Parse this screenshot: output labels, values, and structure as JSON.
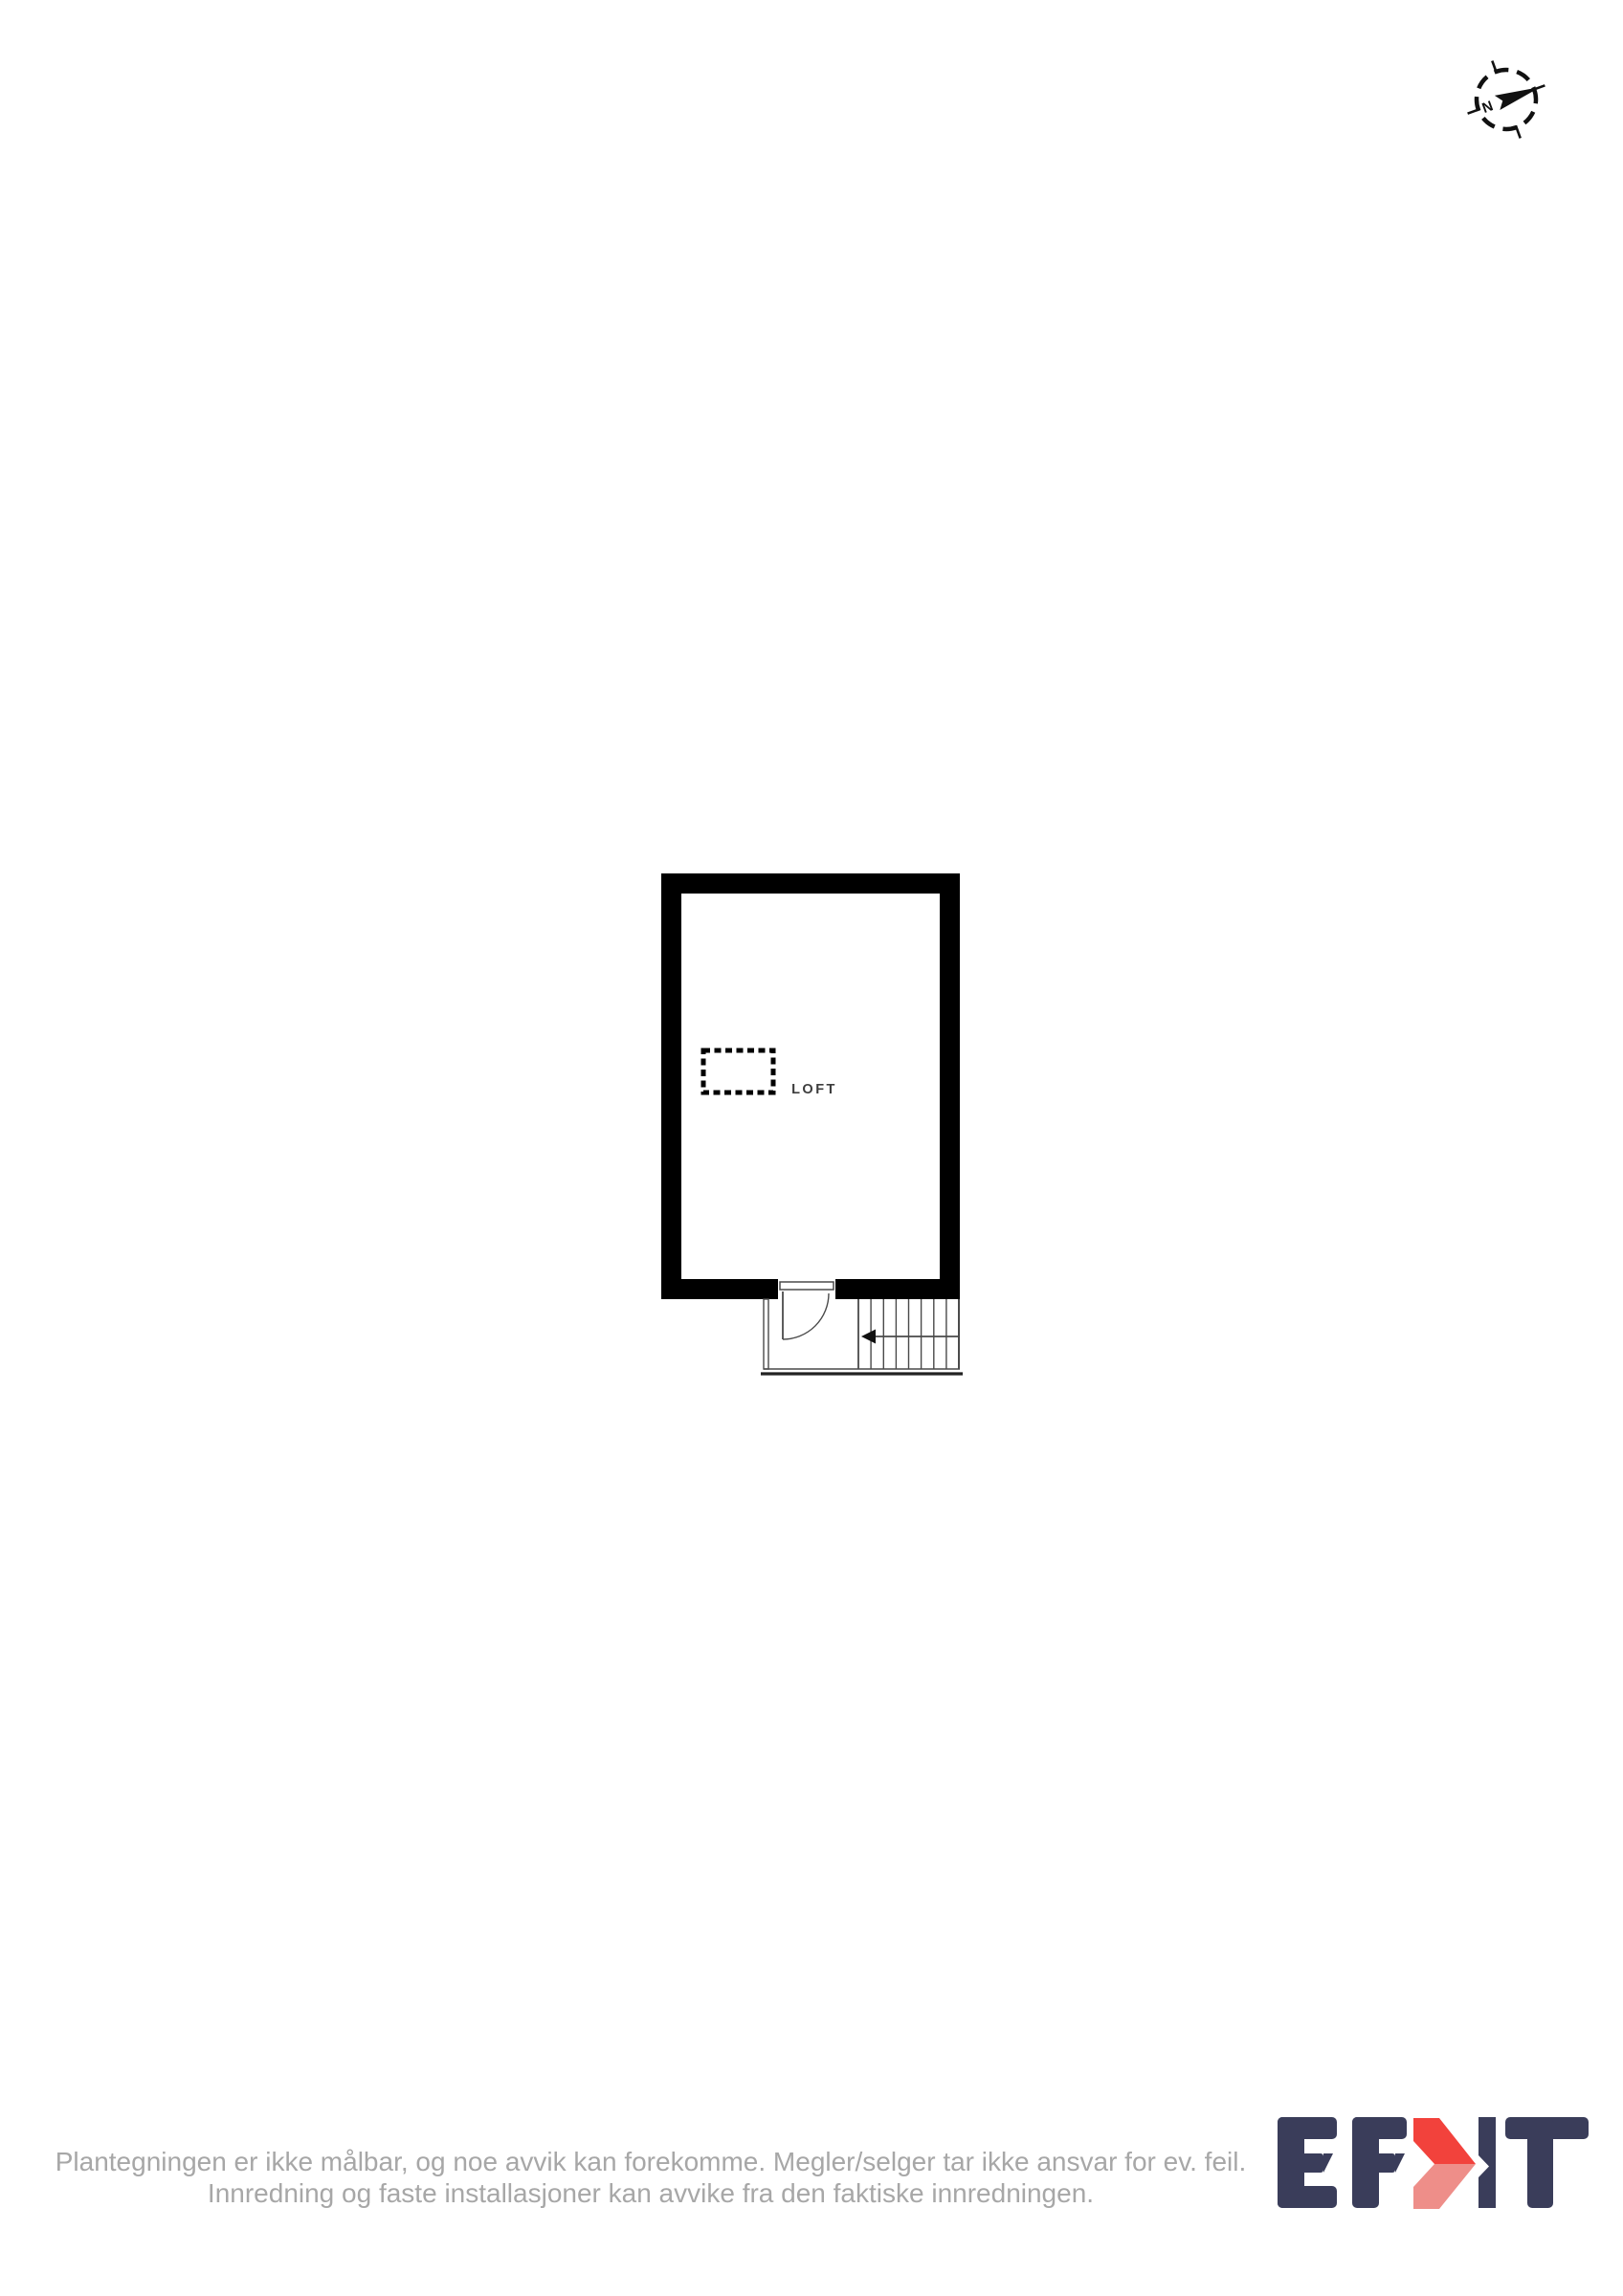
{
  "colors": {
    "wall": "#000000",
    "line": "#4a4a4a",
    "label": "#3d3d3d",
    "graytext": "#a7a7a7",
    "ink": "#111111",
    "navy": "#3a3d5a",
    "red": "#f2423c",
    "lightred": "#ee8e89"
  },
  "compass": {
    "north_label": "N"
  },
  "floor_plan": {
    "room_label": "LOFT",
    "hatch_symbol": "dashed-rect-opening",
    "door_swing": "quarter-arc-down",
    "stairs": {
      "treads": 8,
      "arrow_direction": "left"
    }
  },
  "footer": {
    "line1": "Plantegningen er ikke målbar, og noe avvik kan forekomme. Megler/selger tar ikke ansvar for ev. feil.",
    "line2": "Innredning og faste installasjoner kan avvike fra den faktiske innredningen."
  },
  "logo": {
    "text": "EFKT"
  }
}
